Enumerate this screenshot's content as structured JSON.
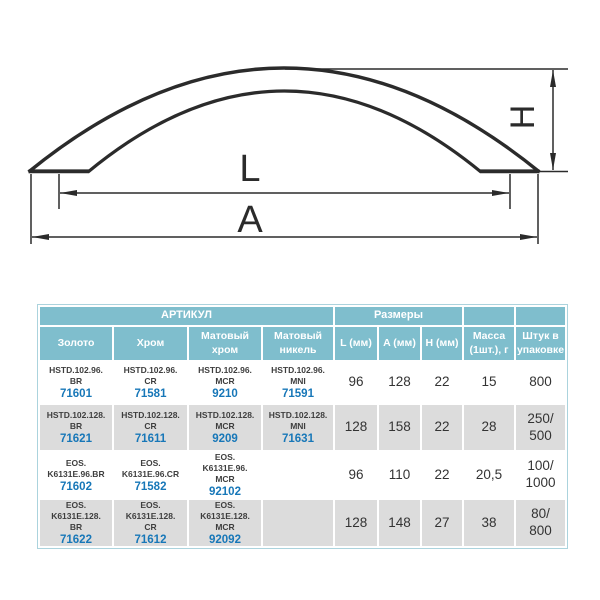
{
  "drawing": {
    "dim_length_label": "L",
    "dim_overall_label": "A",
    "dim_height_label": "H",
    "stroke_color": "#2b2b2b"
  },
  "table": {
    "colors": {
      "header_bg": "#7fbecd",
      "header_text": "#ffffff",
      "article_number_blue": "#1777b8",
      "alt_row_bg": "#dcdcdc",
      "outer_border": "#abd3dd"
    },
    "header": {
      "article_group": "АРТИКУЛ",
      "sizes_group": "Размеры",
      "finishes": [
        "Золото",
        "Хром",
        "Матовый\nхром",
        "Матовый\nникель"
      ],
      "size_cols": [
        "L (мм)",
        "A (мм)",
        "H (мм)"
      ],
      "mass_col": "Масса\n(1шт.), г",
      "pack_col": "Штук в\nупаковке"
    },
    "rows": [
      {
        "articles": [
          {
            "code": "HSTD.102.96.\nBR",
            "number": "71601"
          },
          {
            "code": "HSTD.102.96.\nCR",
            "number": "71581"
          },
          {
            "code": "HSTD.102.96.\nMCR",
            "number": "9210"
          },
          {
            "code": "HSTD.102.96.\nMNI",
            "number": "71591"
          }
        ],
        "l": "96",
        "a": "128",
        "h": "22",
        "mass": "15",
        "pack": "800"
      },
      {
        "articles": [
          {
            "code": "HSTD.102.128.\nBR",
            "number": "71621"
          },
          {
            "code": "HSTD.102.128.\nCR",
            "number": "71611"
          },
          {
            "code": "HSTD.102.128.\nMCR",
            "number": "9209"
          },
          {
            "code": "HSTD.102.128.\nMNI",
            "number": "71631"
          }
        ],
        "l": "128",
        "a": "158",
        "h": "22",
        "mass": "28",
        "pack": "250/\n500"
      },
      {
        "articles": [
          {
            "code": "EOS.\nK6131E.96.BR",
            "number": "71602"
          },
          {
            "code": "EOS.\nK6131E.96.CR",
            "number": "71582"
          },
          {
            "code": "EOS.\nK6131E.96.\nMCR",
            "number": "92102"
          },
          {
            "code": "",
            "number": ""
          }
        ],
        "l": "96",
        "a": "110",
        "h": "22",
        "mass": "20,5",
        "pack": "100/\n1000"
      },
      {
        "articles": [
          {
            "code": "EOS.\nK6131E.128.\nBR",
            "number": "71622"
          },
          {
            "code": "EOS.\nK6131E.128.\nCR",
            "number": "71612"
          },
          {
            "code": "EOS.\nK6131E.128.\nMCR",
            "number": "92092"
          },
          {
            "code": "",
            "number": ""
          }
        ],
        "l": "128",
        "a": "148",
        "h": "27",
        "mass": "38",
        "pack": "80/\n800"
      }
    ]
  }
}
